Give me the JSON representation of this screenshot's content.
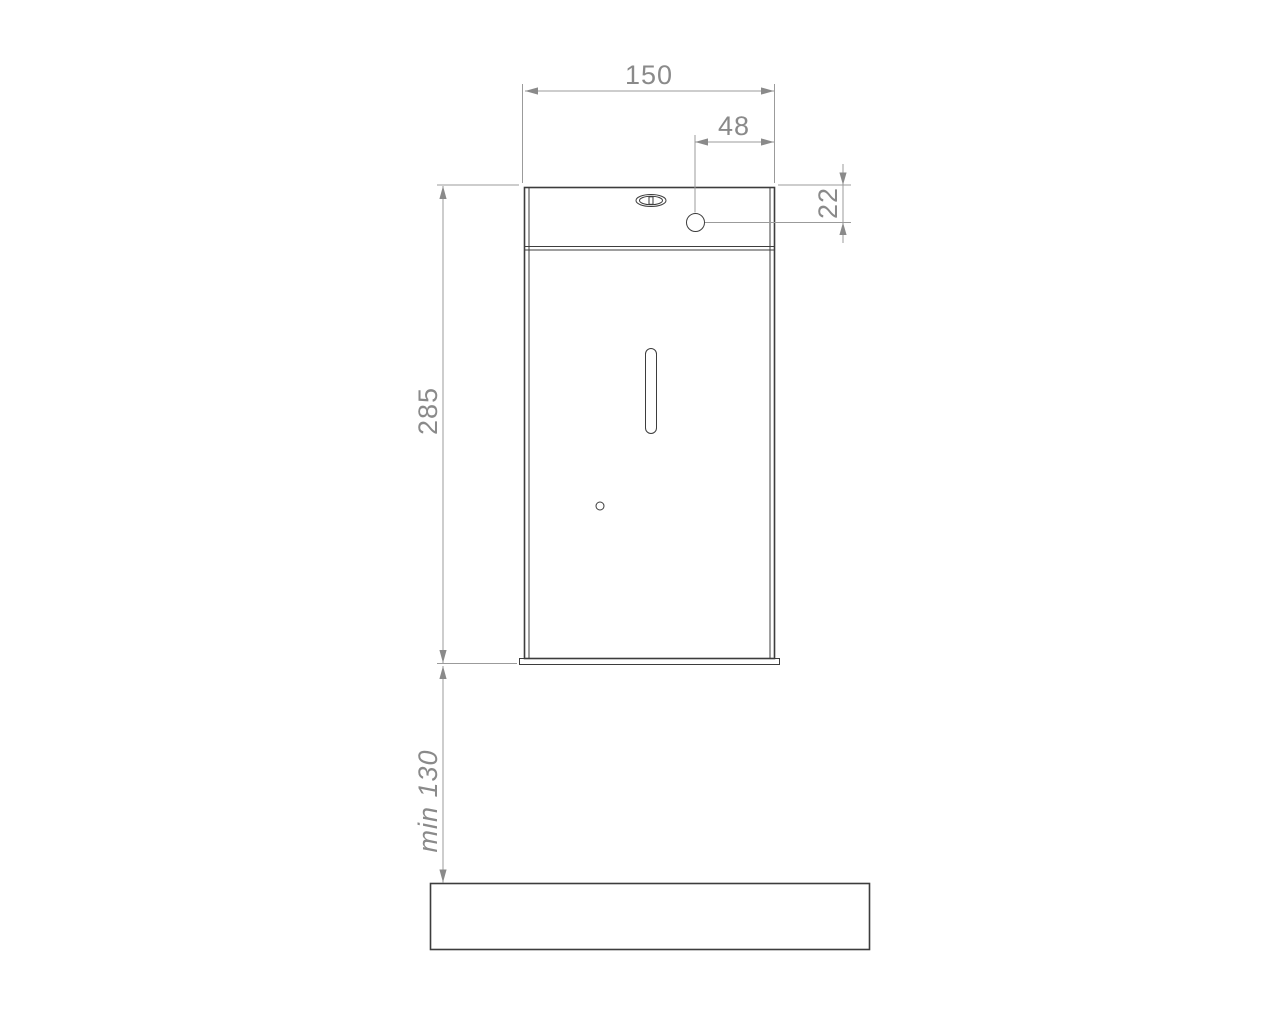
{
  "drawing": {
    "type": "technical-dimension-drawing",
    "view": "dispenser-front-elevation",
    "dimensions": {
      "body_width": "150",
      "hole_offset_from_right": "48",
      "hole_offset_from_top": "22",
      "body_height": "285",
      "clearance_below": "min 130"
    },
    "colors": {
      "background": "#ffffff",
      "object_line": "#3d3d3d",
      "dimension_line": "#9b9b9b",
      "dimension_text": "#8a8a8a"
    }
  }
}
